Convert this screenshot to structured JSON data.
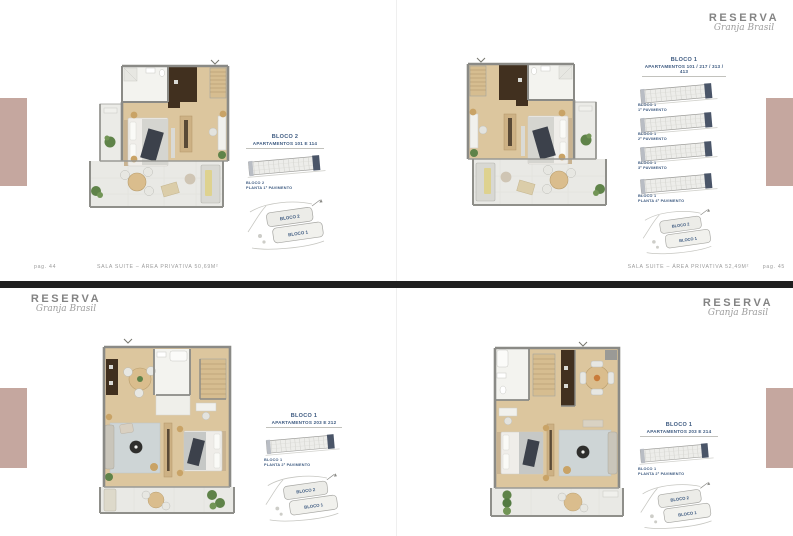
{
  "brand": {
    "name": "RESERVA",
    "tagline": "Granja Brasil"
  },
  "panels": [
    {
      "block": "BLOCO 2",
      "apartments": "APARTAMENTOS 101 E 114",
      "key_captions": [
        {
          "l1": "BLOCO 2",
          "l2": "PLANTA 1º PAVIMENTO"
        }
      ],
      "site_labels": [
        "BLOCO 2",
        "BLOCO 1"
      ]
    },
    {
      "block": "BLOCO 1",
      "apartments": "APARTAMENTOS 101 / 217 / 313 / 413",
      "key_captions": [
        {
          "l1": "BLOCO 1",
          "l2": "1º PAVIMENTO"
        },
        {
          "l1": "BLOCO 1",
          "l2": "2º PAVIMENTO"
        },
        {
          "l1": "BLOCO 1",
          "l2": "3º PAVIMENTO"
        },
        {
          "l1": "BLOCO 1",
          "l2": "PLANTA 4º PAVIMENTO"
        }
      ],
      "site_labels": [
        "BLOCO 2",
        "BLOCO 1"
      ]
    },
    {
      "block": "BLOCO 1",
      "apartments": "APARTAMENTOS 203 E 212",
      "key_captions": [
        {
          "l1": "BLOCO 1",
          "l2": "PLANTA 2º PAVIMENTO"
        }
      ],
      "site_labels": [
        "BLOCO 2",
        "BLOCO 1"
      ]
    },
    {
      "block": "BLOCO 1",
      "apartments": "APARTAMENTOS 203 E 214",
      "key_captions": [
        {
          "l1": "BLOCO 1",
          "l2": "PLANTA 2º PAVIMENTO"
        }
      ],
      "site_labels": [
        "BLOCO 2",
        "BLOCO 1"
      ]
    }
  ],
  "footers": {
    "left": {
      "page": "pag. 44",
      "text": "SALA SUITE – ÁREA PRIVATIVA 50,69M²"
    },
    "right": {
      "text": "SALA SUITE – ÁREA PRIVATIVA 52,49M²",
      "page": "pag. 45"
    }
  },
  "colors": {
    "accent_strip": "#c5a79f",
    "wood_floor": "#dcc69e",
    "dark_cabinet": "#41301f",
    "wall": "#8a8a86",
    "terrace": "#e9e9e5",
    "label_blue": "#3d5a80"
  }
}
